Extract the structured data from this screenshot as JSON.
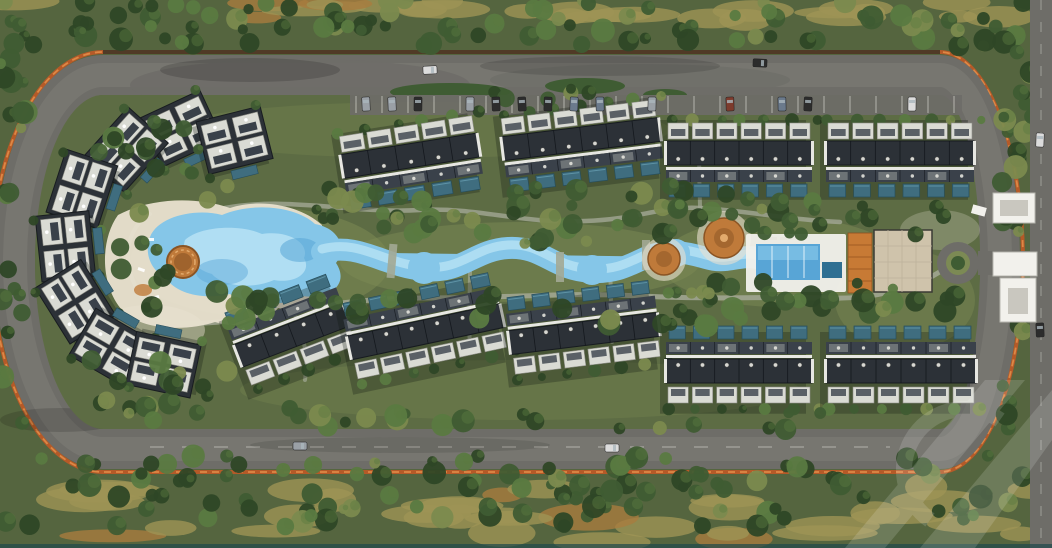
{
  "scene": {
    "description": "Aerial 3D render of a residential compound master plan: an oval perimeter road with orange fencing encloses rows of dark-roofed apartment buildings and villa clusters, each with private teal pools, arranged around a winding light-blue lazy-river pool with a sandy lagoon beach, round orange shade islands, a clubhouse with beige pergola roof and orange canopy, landscaped gardens, parking along the top boulevard, and an entrance gate with roundabout on the right edge; dense trees and dry desert grass surround the compound.",
    "visible_text": "",
    "counts": {
      "building_rows": 9,
      "villa_clusters": 8,
      "shade_islands": 3
    }
  },
  "watermark": {
    "present": true,
    "position": "bottom-right",
    "color": "#ffffff",
    "opacity": 0.14
  },
  "colors": {
    "groundBase": "#55653f",
    "interiorGreen": "#5d6c44",
    "lawnLight": "#7c8a54",
    "road": "#6e6d68",
    "roadLight": "#82817b",
    "pathGray": "#a3a895",
    "fenceOrange": "#b55a28",
    "fenceBright": "#dd8845",
    "sand": "#e9e1d0",
    "riverBlue": "#85c6e8",
    "riverLight": "#b7e2f4",
    "riverDeep": "#58a5d6",
    "poolTeal": "#3f6d7f",
    "islandOrange": "#bf7a3a",
    "islandDark": "#8a5424",
    "roofDark": "#2c3137",
    "roofMid": "#3a414a",
    "parapetWhite": "#e7e7e2",
    "balconyWhite": "#dadbd4",
    "clubBeige": "#cfc3ab",
    "clubOrange": "#c77a35",
    "white": "#f2f1ec",
    "treeDark": "#2e4726",
    "treeMid": "#3f5c33",
    "treeLight": "#5a7a41",
    "treeYellow": "#7b8a4e",
    "dryGrass": "#9d9355",
    "dryOrange": "#a87c3e",
    "bottomTeal": "#20494b",
    "carDark": "#2c2c2c",
    "carWhite": "#dcdcdc",
    "carSilver": "#9aa0a6"
  }
}
